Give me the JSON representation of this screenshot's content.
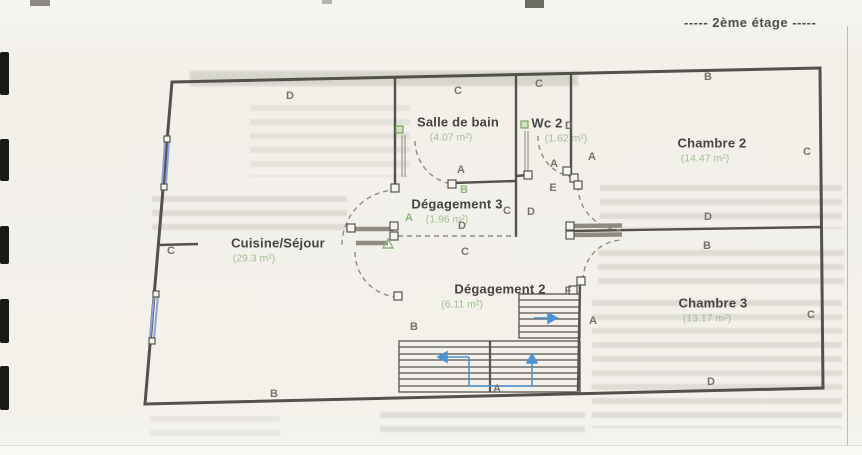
{
  "page": {
    "floor_label": "-----  2ème étage  -----"
  },
  "plan": {
    "rooms": [
      {
        "name": "Salle de bain",
        "area": "(4.07 m²)",
        "x": 458,
        "y": 121,
        "ax": 451,
        "ay": 141
      },
      {
        "name": "Wc 2",
        "area": "(1.62 m²)",
        "x": 547,
        "y": 122,
        "ax": 566,
        "ay": 141
      },
      {
        "name": "Chambre 2",
        "area": "(14.47 m²)",
        "x": 712,
        "y": 142,
        "ax": 705,
        "ay": 162
      },
      {
        "name": "Dégagement 3",
        "area": "(1.96 m²)",
        "x": 457,
        "y": 203,
        "ax": 447,
        "ay": 221
      },
      {
        "name": "Cuisine/Séjour",
        "area": "(29.3 m²)",
        "x": 278,
        "y": 242,
        "ax": 254,
        "ay": 262
      },
      {
        "name": "Dégagement 2",
        "area": "(6.11 m²)",
        "x": 500,
        "y": 288,
        "ax": 462,
        "ay": 306
      },
      {
        "name": "Chambre 3",
        "area": "(13.17 m²)",
        "x": 713,
        "y": 302,
        "ax": 707,
        "ay": 321
      }
    ],
    "point_labels": [
      {
        "label": "D",
        "x": 290,
        "y": 96
      },
      {
        "label": "C",
        "x": 458,
        "y": 91
      },
      {
        "label": "C",
        "x": 539,
        "y": 84
      },
      {
        "label": "B",
        "x": 708,
        "y": 77
      },
      {
        "label": "C",
        "x": 807,
        "y": 152
      },
      {
        "label": "D",
        "x": 569,
        "y": 126
      },
      {
        "label": "A",
        "x": 554,
        "y": 164
      },
      {
        "label": "A",
        "x": 592,
        "y": 157
      },
      {
        "label": "E",
        "x": 553,
        "y": 188
      },
      {
        "label": "A",
        "x": 461,
        "y": 170
      },
      {
        "label": "B",
        "x": 464,
        "y": 190,
        "green": true
      },
      {
        "label": "C",
        "x": 507,
        "y": 211
      },
      {
        "label": "D",
        "x": 531,
        "y": 212
      },
      {
        "label": "A",
        "x": 409,
        "y": 218,
        "green": true
      },
      {
        "label": "D",
        "x": 462,
        "y": 226
      },
      {
        "label": "C",
        "x": 465,
        "y": 252
      },
      {
        "label": "C",
        "x": 171,
        "y": 251
      },
      {
        "label": "D",
        "x": 708,
        "y": 217
      },
      {
        "label": "B",
        "x": 707,
        "y": 246
      },
      {
        "label": "B",
        "x": 414,
        "y": 327
      },
      {
        "label": "F",
        "x": 568,
        "y": 291
      },
      {
        "label": "A",
        "x": 593,
        "y": 321
      },
      {
        "label": "C",
        "x": 811,
        "y": 315
      },
      {
        "label": "A",
        "x": 497,
        "y": 389
      },
      {
        "label": "B",
        "x": 274,
        "y": 394
      },
      {
        "label": "D",
        "x": 711,
        "y": 382
      }
    ],
    "colors": {
      "wall": "#53514b",
      "annotation_green": "#8cb878",
      "window_blue": "#8aa4d4",
      "arrow_blue": "#4b93d6"
    }
  }
}
